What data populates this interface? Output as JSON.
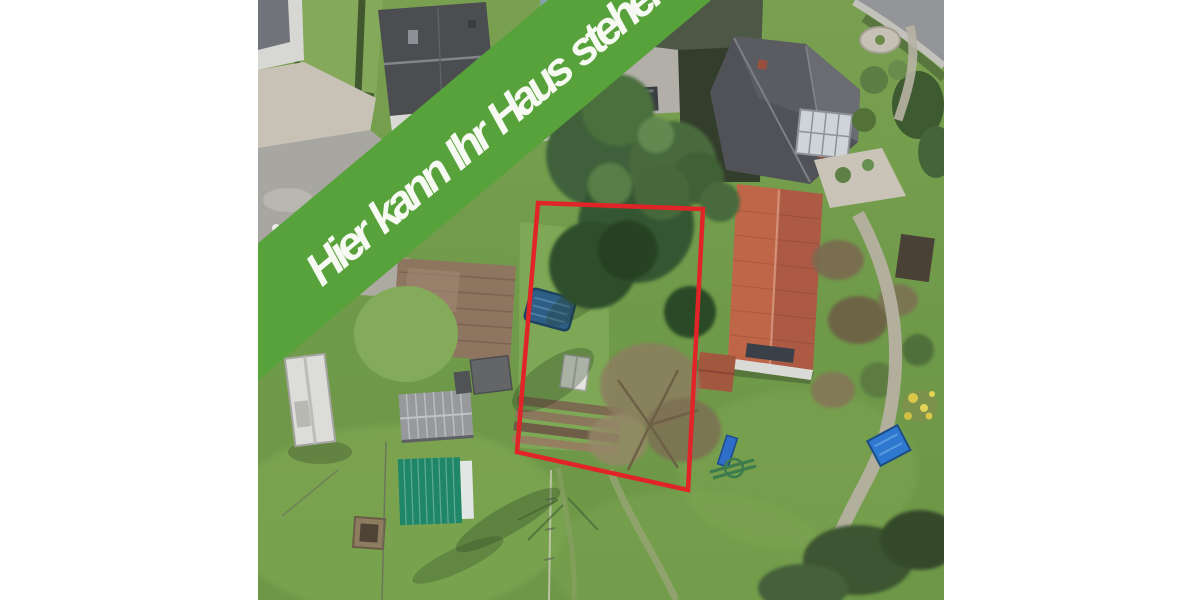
{
  "banner": {
    "label": "Hier kann Ihr Haus stehen"
  },
  "palette": {
    "banner_green": "#58a23c",
    "banner_text": "#f7faf2",
    "plot_red": "#e02428",
    "page_bg": "#ffffff"
  },
  "scene": {
    "type": "aerial-photograph",
    "features": [
      "marked-building-plot",
      "conifer-trees",
      "bare-tree",
      "covered-garden-pool",
      "vegetable-beds",
      "lawns",
      "green-roof-shed",
      "gray-shed",
      "white-carport",
      "wooden-terrace",
      "red-tile-roof-house",
      "dark-roof-houses",
      "street",
      "gravel-paths",
      "blue-sandbox",
      "playground-slide",
      "yellow-flower-bush"
    ]
  }
}
